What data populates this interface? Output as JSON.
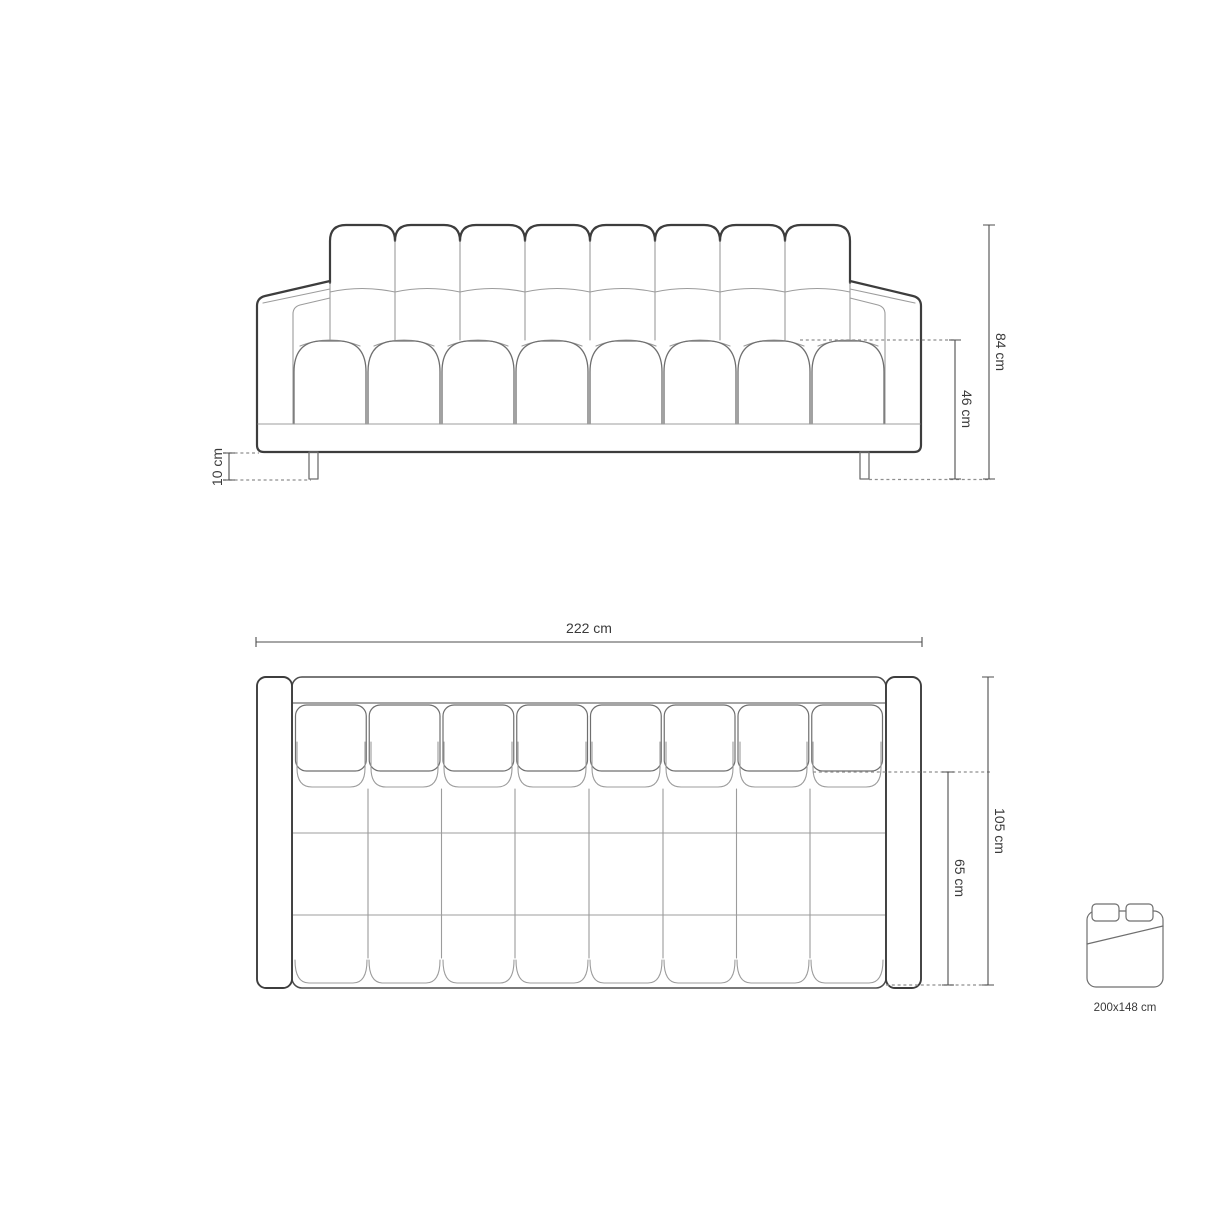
{
  "style": {
    "background": "#ffffff",
    "outline_dark": "#3d3d3d",
    "line_medium": "#6f6f6f",
    "line_light": "#9c9c9c",
    "dimension_line": "#4d4d4d",
    "dashed_line": "#8f8f8f",
    "label_text": "#3a3a3a"
  },
  "front_view": {
    "dims": {
      "total_height": "84 cm",
      "seat_height": "46 cm",
      "leg_height": "10 cm"
    }
  },
  "top_view": {
    "dims": {
      "total_width": "222 cm",
      "total_depth": "105 cm",
      "seat_depth": "65 cm"
    }
  },
  "sleeping_area": {
    "size_label": "200x148 cm"
  }
}
